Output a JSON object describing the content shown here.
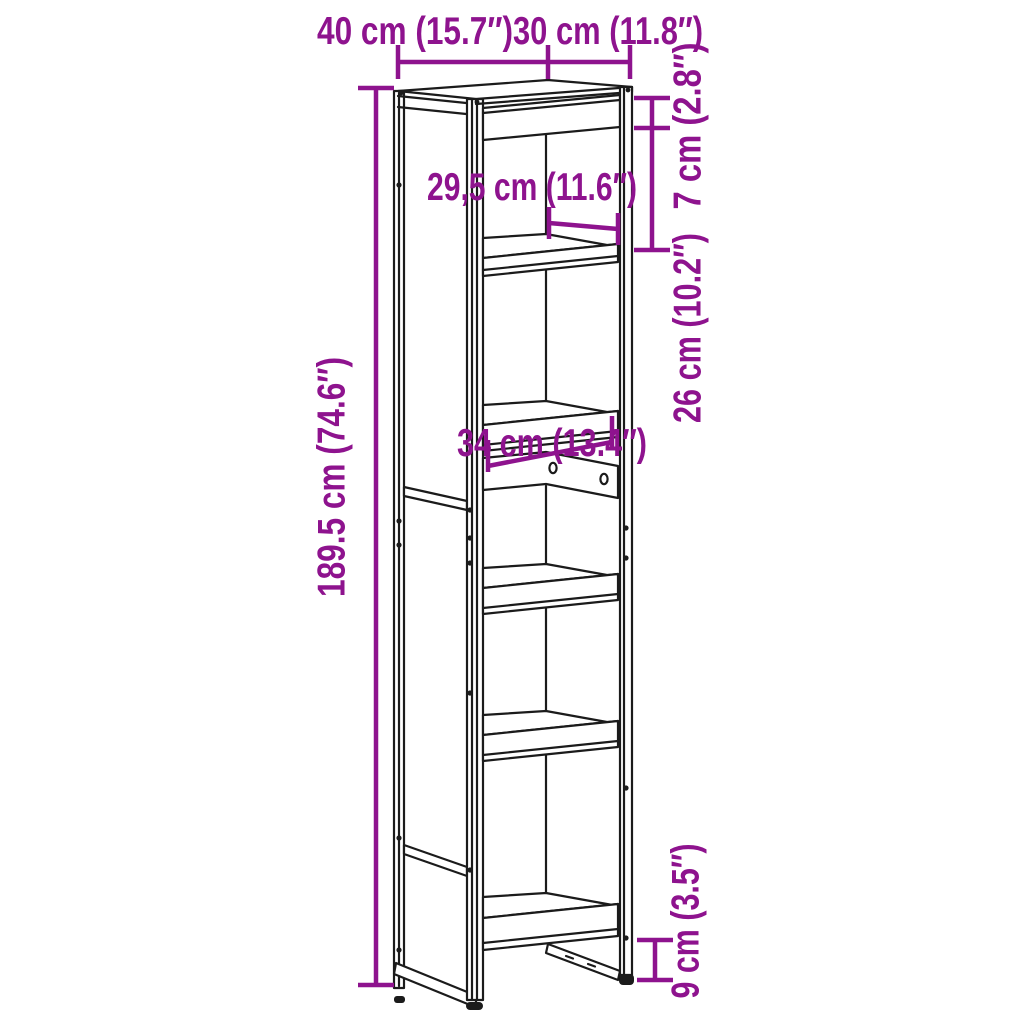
{
  "diagram": {
    "type": "furniture-dimension-diagram",
    "subject": "tall-narrow-bookcase-line-drawing",
    "colors": {
      "dimension_accent": "#8E138E",
      "line_art": "#1B1B1B",
      "background": "#FFFFFF"
    },
    "dimensions": {
      "width": "40 cm (15.7″)",
      "depth": "30 cm (11.8″)",
      "top_rail_height": "7 cm (2.8″)",
      "top_compartment_height": "26 cm (10.2″)",
      "inner_depth": "29,5 cm (11.6″)",
      "inner_width": "34 cm (13.4″)",
      "total_height": "189.5 cm (74.6″)",
      "bottom_clearance": "9 cm (3.5″)"
    }
  }
}
